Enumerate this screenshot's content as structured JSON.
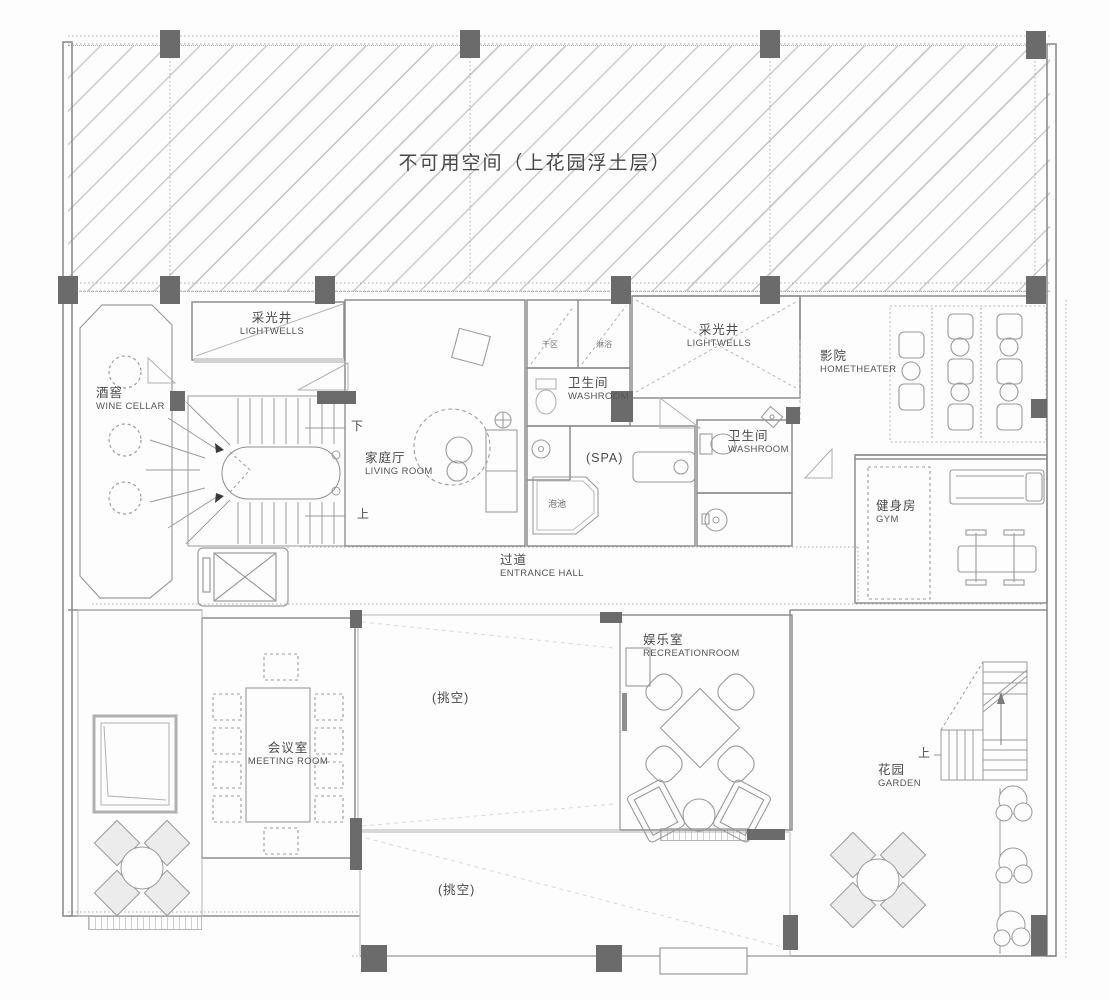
{
  "title": {
    "text": "不可用空间（上花园浮土层）"
  },
  "rooms": {
    "lightwells_left": {
      "zh": "采光井",
      "en": "LIGHTWELLS"
    },
    "lightwells_right": {
      "zh": "采光井",
      "en": "LIGHTWELLS"
    },
    "wine_cellar": {
      "zh": "酒窖",
      "en": "WINE CELLAR"
    },
    "living_room": {
      "zh": "家庭厅",
      "en": "LIVING ROOM"
    },
    "washroom_upper": {
      "zh": "卫生间",
      "en": "WASHROOM"
    },
    "washroom_lower": {
      "zh": "卫生间",
      "en": "WASHROOM"
    },
    "spa": {
      "zh": "(SPA)"
    },
    "home_theater": {
      "zh": "影院",
      "en": "HOMETHEATER"
    },
    "gym": {
      "zh": "健身房",
      "en": "GYM"
    },
    "entrance_hall": {
      "zh": "过道",
      "en": "ENTRANCE HALL"
    },
    "meeting_room": {
      "zh": "会议室",
      "en": "MEETING ROOM"
    },
    "recreation_room": {
      "zh": "娱乐室",
      "en": "RECREATIONROOM"
    },
    "garden": {
      "zh": "花园",
      "en": "GARDEN"
    },
    "void_upper": {
      "zh": "(挑空)"
    },
    "void_lower": {
      "zh": "(挑空)"
    }
  },
  "annotations": {
    "dry_area": "干区",
    "shower": "淋浴",
    "soak_pool": "泡池",
    "stair_down": "下",
    "stair_up": "上",
    "garden_stair_up": "上"
  },
  "colors": {
    "wall": "#8e8e8e",
    "column": "#6b6b6b",
    "hatch_line": "#cacaca",
    "text": "#4a4a4a"
  }
}
